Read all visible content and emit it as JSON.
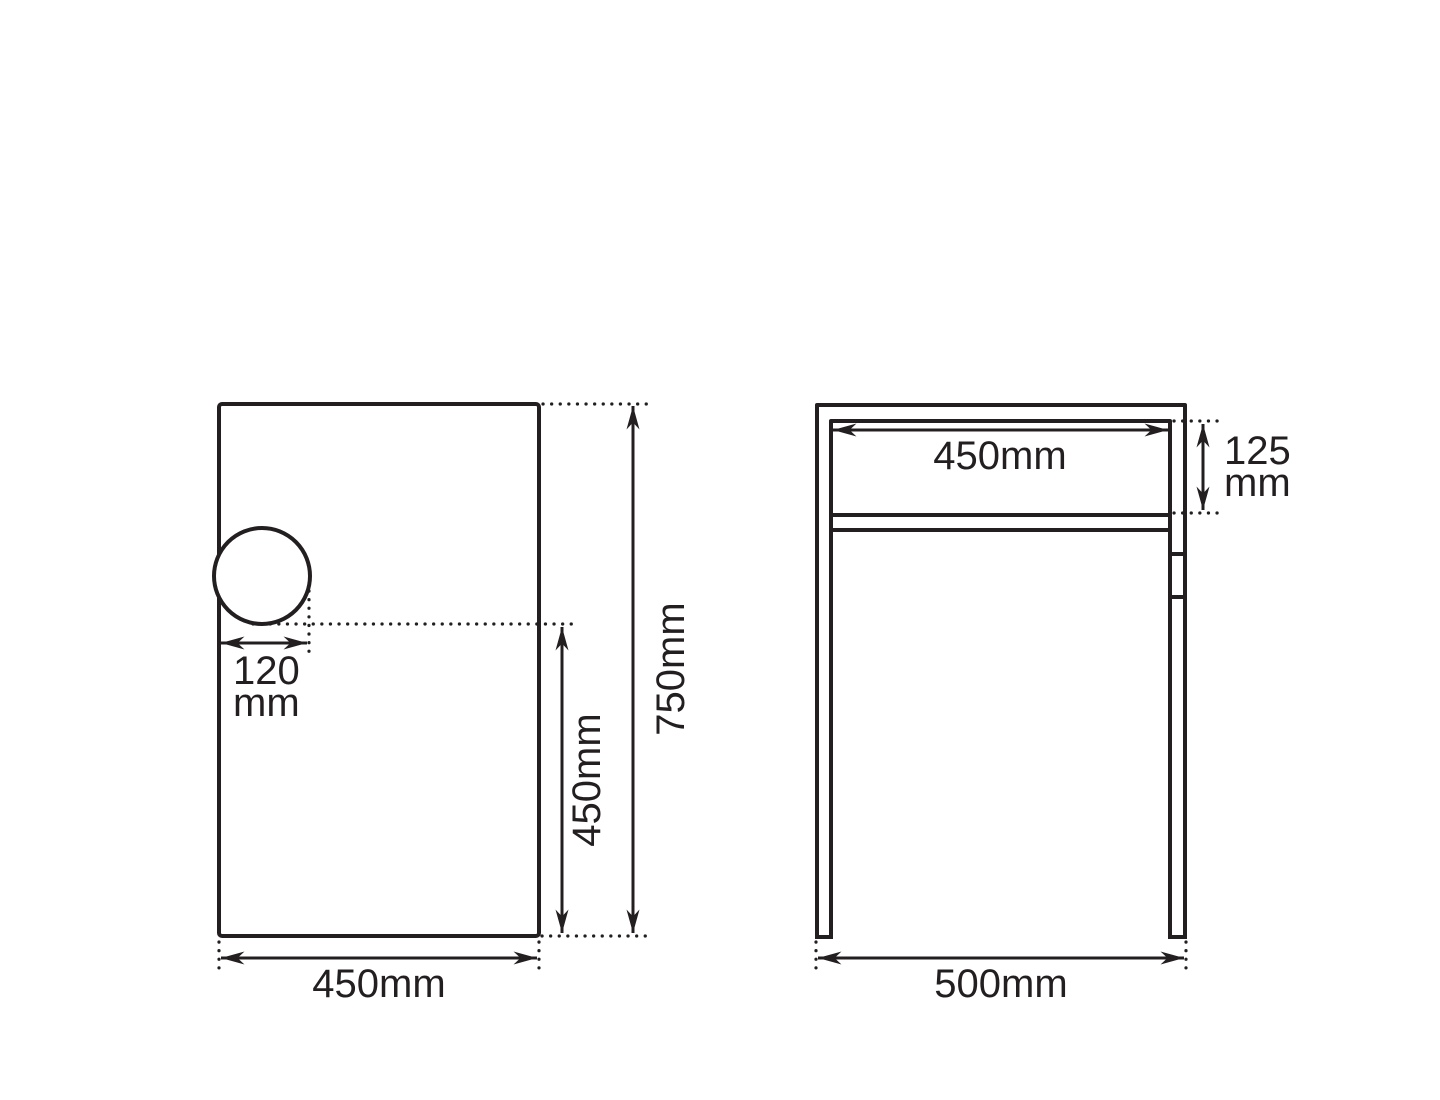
{
  "drawing": {
    "line_color": "#231f20",
    "background_color": "#ffffff",
    "front_panel_view": {
      "bottom_width_label": "450mm",
      "overall_height_label": "750mm",
      "partial_height_label": "450mm",
      "hole_offset_value": "120",
      "hole_offset_unit": "mm"
    },
    "side_frame_view": {
      "inner_width_label": "450mm",
      "apron_height_value": "125",
      "apron_height_unit": "mm",
      "overall_width_label": "500mm"
    }
  }
}
